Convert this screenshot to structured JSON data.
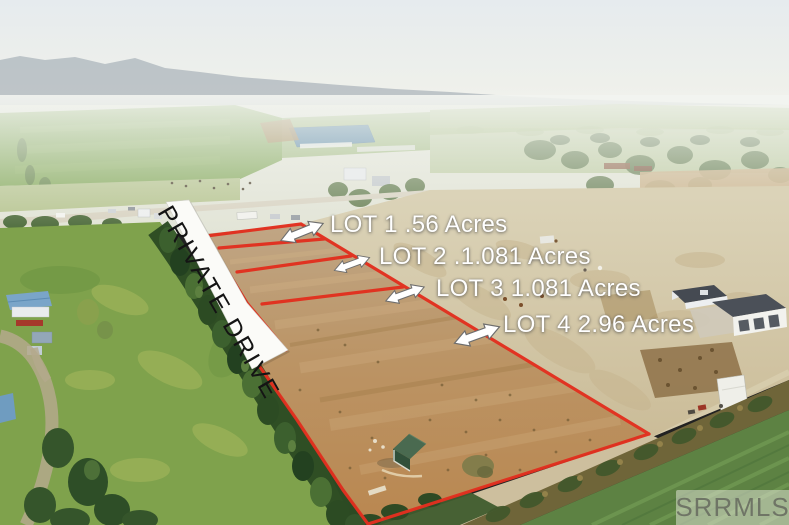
{
  "photo": {
    "labels": {
      "lot1": "LOT 1 .56 Acres",
      "lot2": "LOT 2 .1.081 Acres",
      "lot3": "LOT 3 1.081 Acres",
      "lot4": "LOT 4 2.96 Acres",
      "road": "PRIVATE DRIVE",
      "watermark": "SRRMLS"
    },
    "colors": {
      "boundary_line": "#e2301f",
      "label_text": "#ffffff",
      "drive_band": "#fbfbf8",
      "drive_text": "#141414",
      "watermark_text": "#6f7566"
    }
  }
}
